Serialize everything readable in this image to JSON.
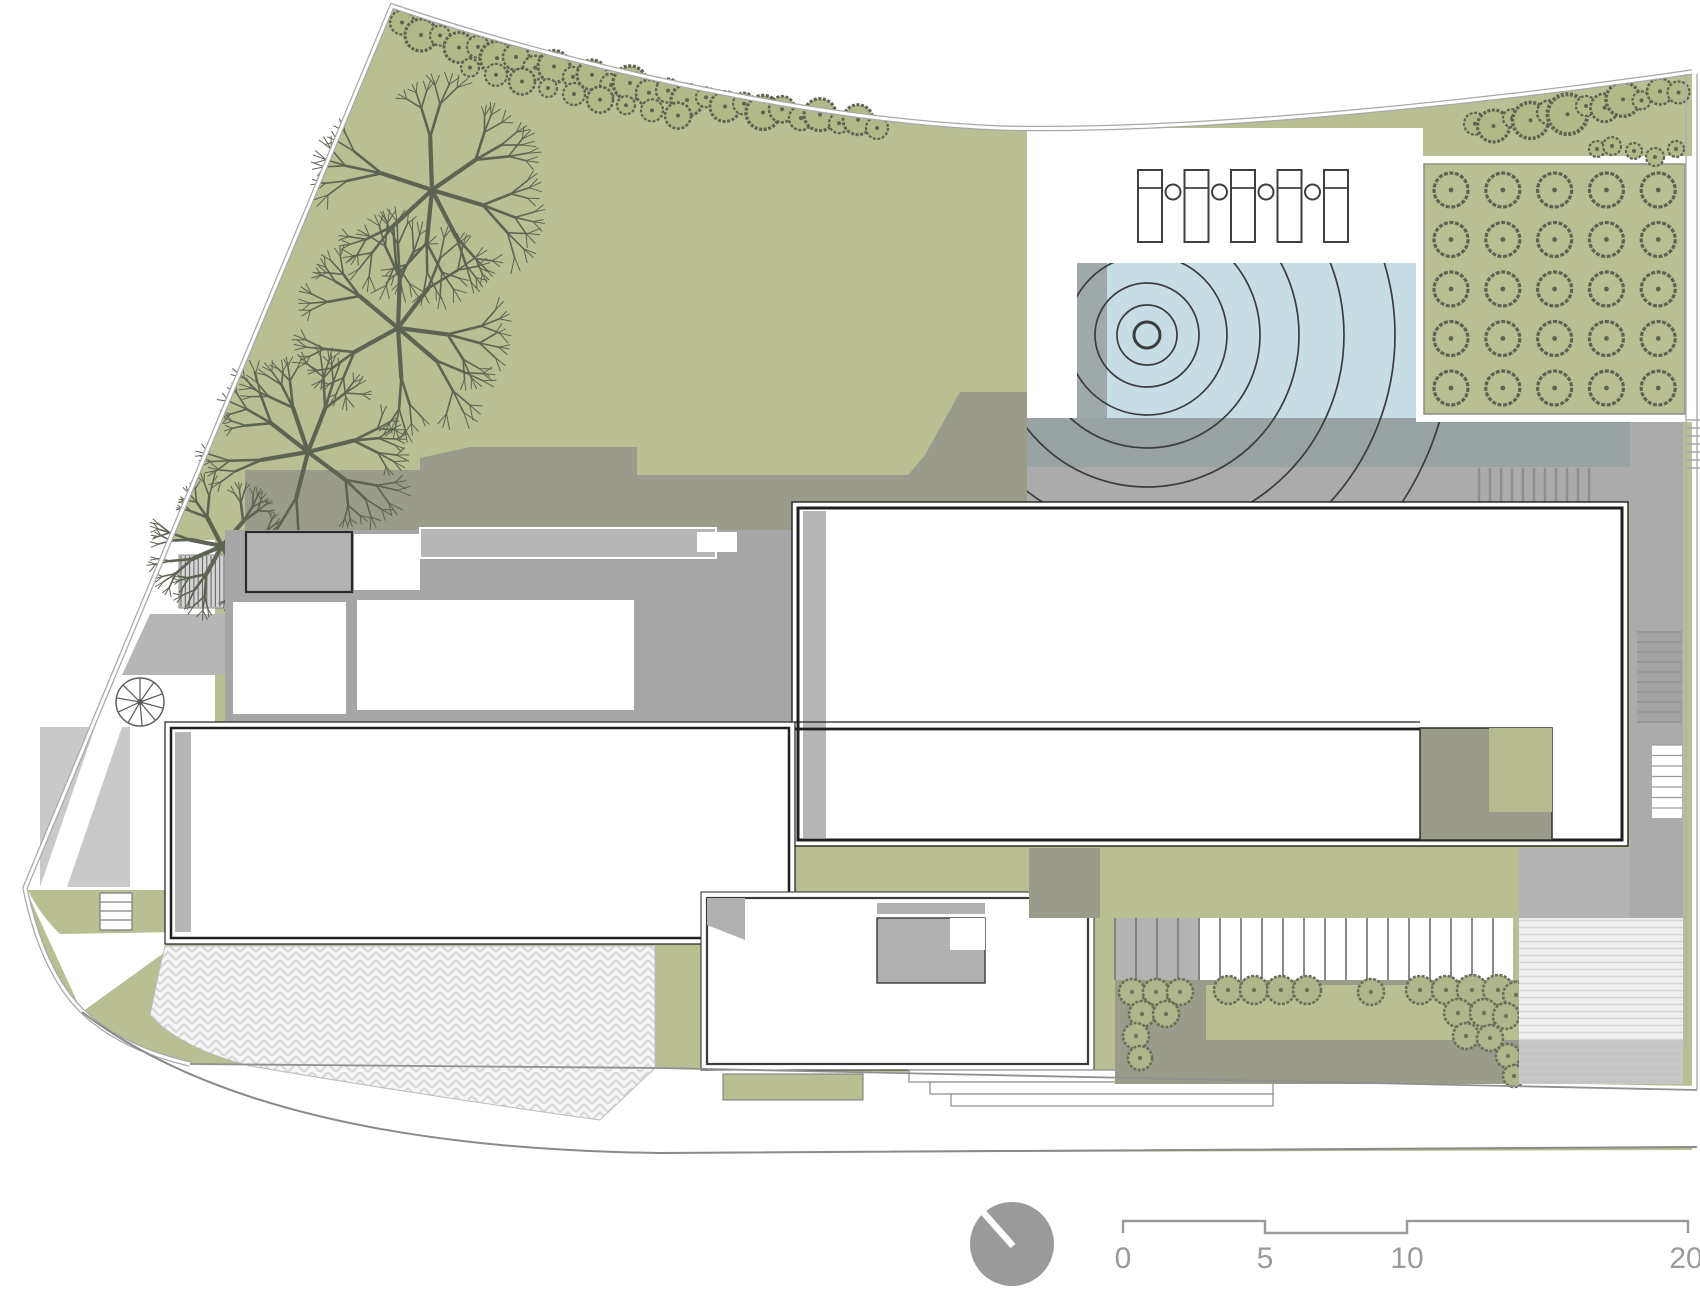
{
  "drawing": {
    "kind": "architectural site plan",
    "level": "roof / garden level",
    "visible_text": [
      "0",
      "5",
      "10",
      "20"
    ]
  },
  "scale_bar": {
    "unit_labels": [
      "0",
      "5",
      "10",
      "20"
    ],
    "style": "stepped bar scale"
  },
  "north_indicator": {
    "type": "filled circle with white needle",
    "needle_direction": "up-left"
  },
  "features": {
    "orchard_grid": {
      "rows": 5,
      "cols": 5
    },
    "pool": {
      "ripple_count": 9
    },
    "lounge_chairs": {
      "count": 5,
      "side_tables": 4
    },
    "large_trees": {
      "count": 4
    },
    "hedge_top": {
      "count": 26,
      "understory": 9
    },
    "hedge_right": {
      "count": 12,
      "understory": 5
    },
    "shrub_bed": {
      "count": 24
    }
  },
  "palette": {
    "lawn": "#b9bf93",
    "lawn_dark": "#b2b989",
    "olive": "#9b9b8c",
    "roof": "#b6b6b6",
    "plate": "#a6a6a6",
    "deck": "#ababab",
    "pool_deck": "#99a3a4",
    "water": "#c6dde3",
    "water_strip": "#9aa3a3",
    "wall": "#1f1f1f",
    "line": "#8a8a8a",
    "tree": "#5d6452",
    "orchard_line": "#5c6352",
    "shrub": "#b0b68c",
    "shrub_line": "#6a7158",
    "paving": "#f2f2f2",
    "paving_line": "#d4d4d4",
    "annot": "#9a9a9a",
    "light_room": "#b2b2b2",
    "block_olive": "#9a9a8b",
    "block_green": "#b5bb8e",
    "ramp": "#c9c9c9"
  }
}
